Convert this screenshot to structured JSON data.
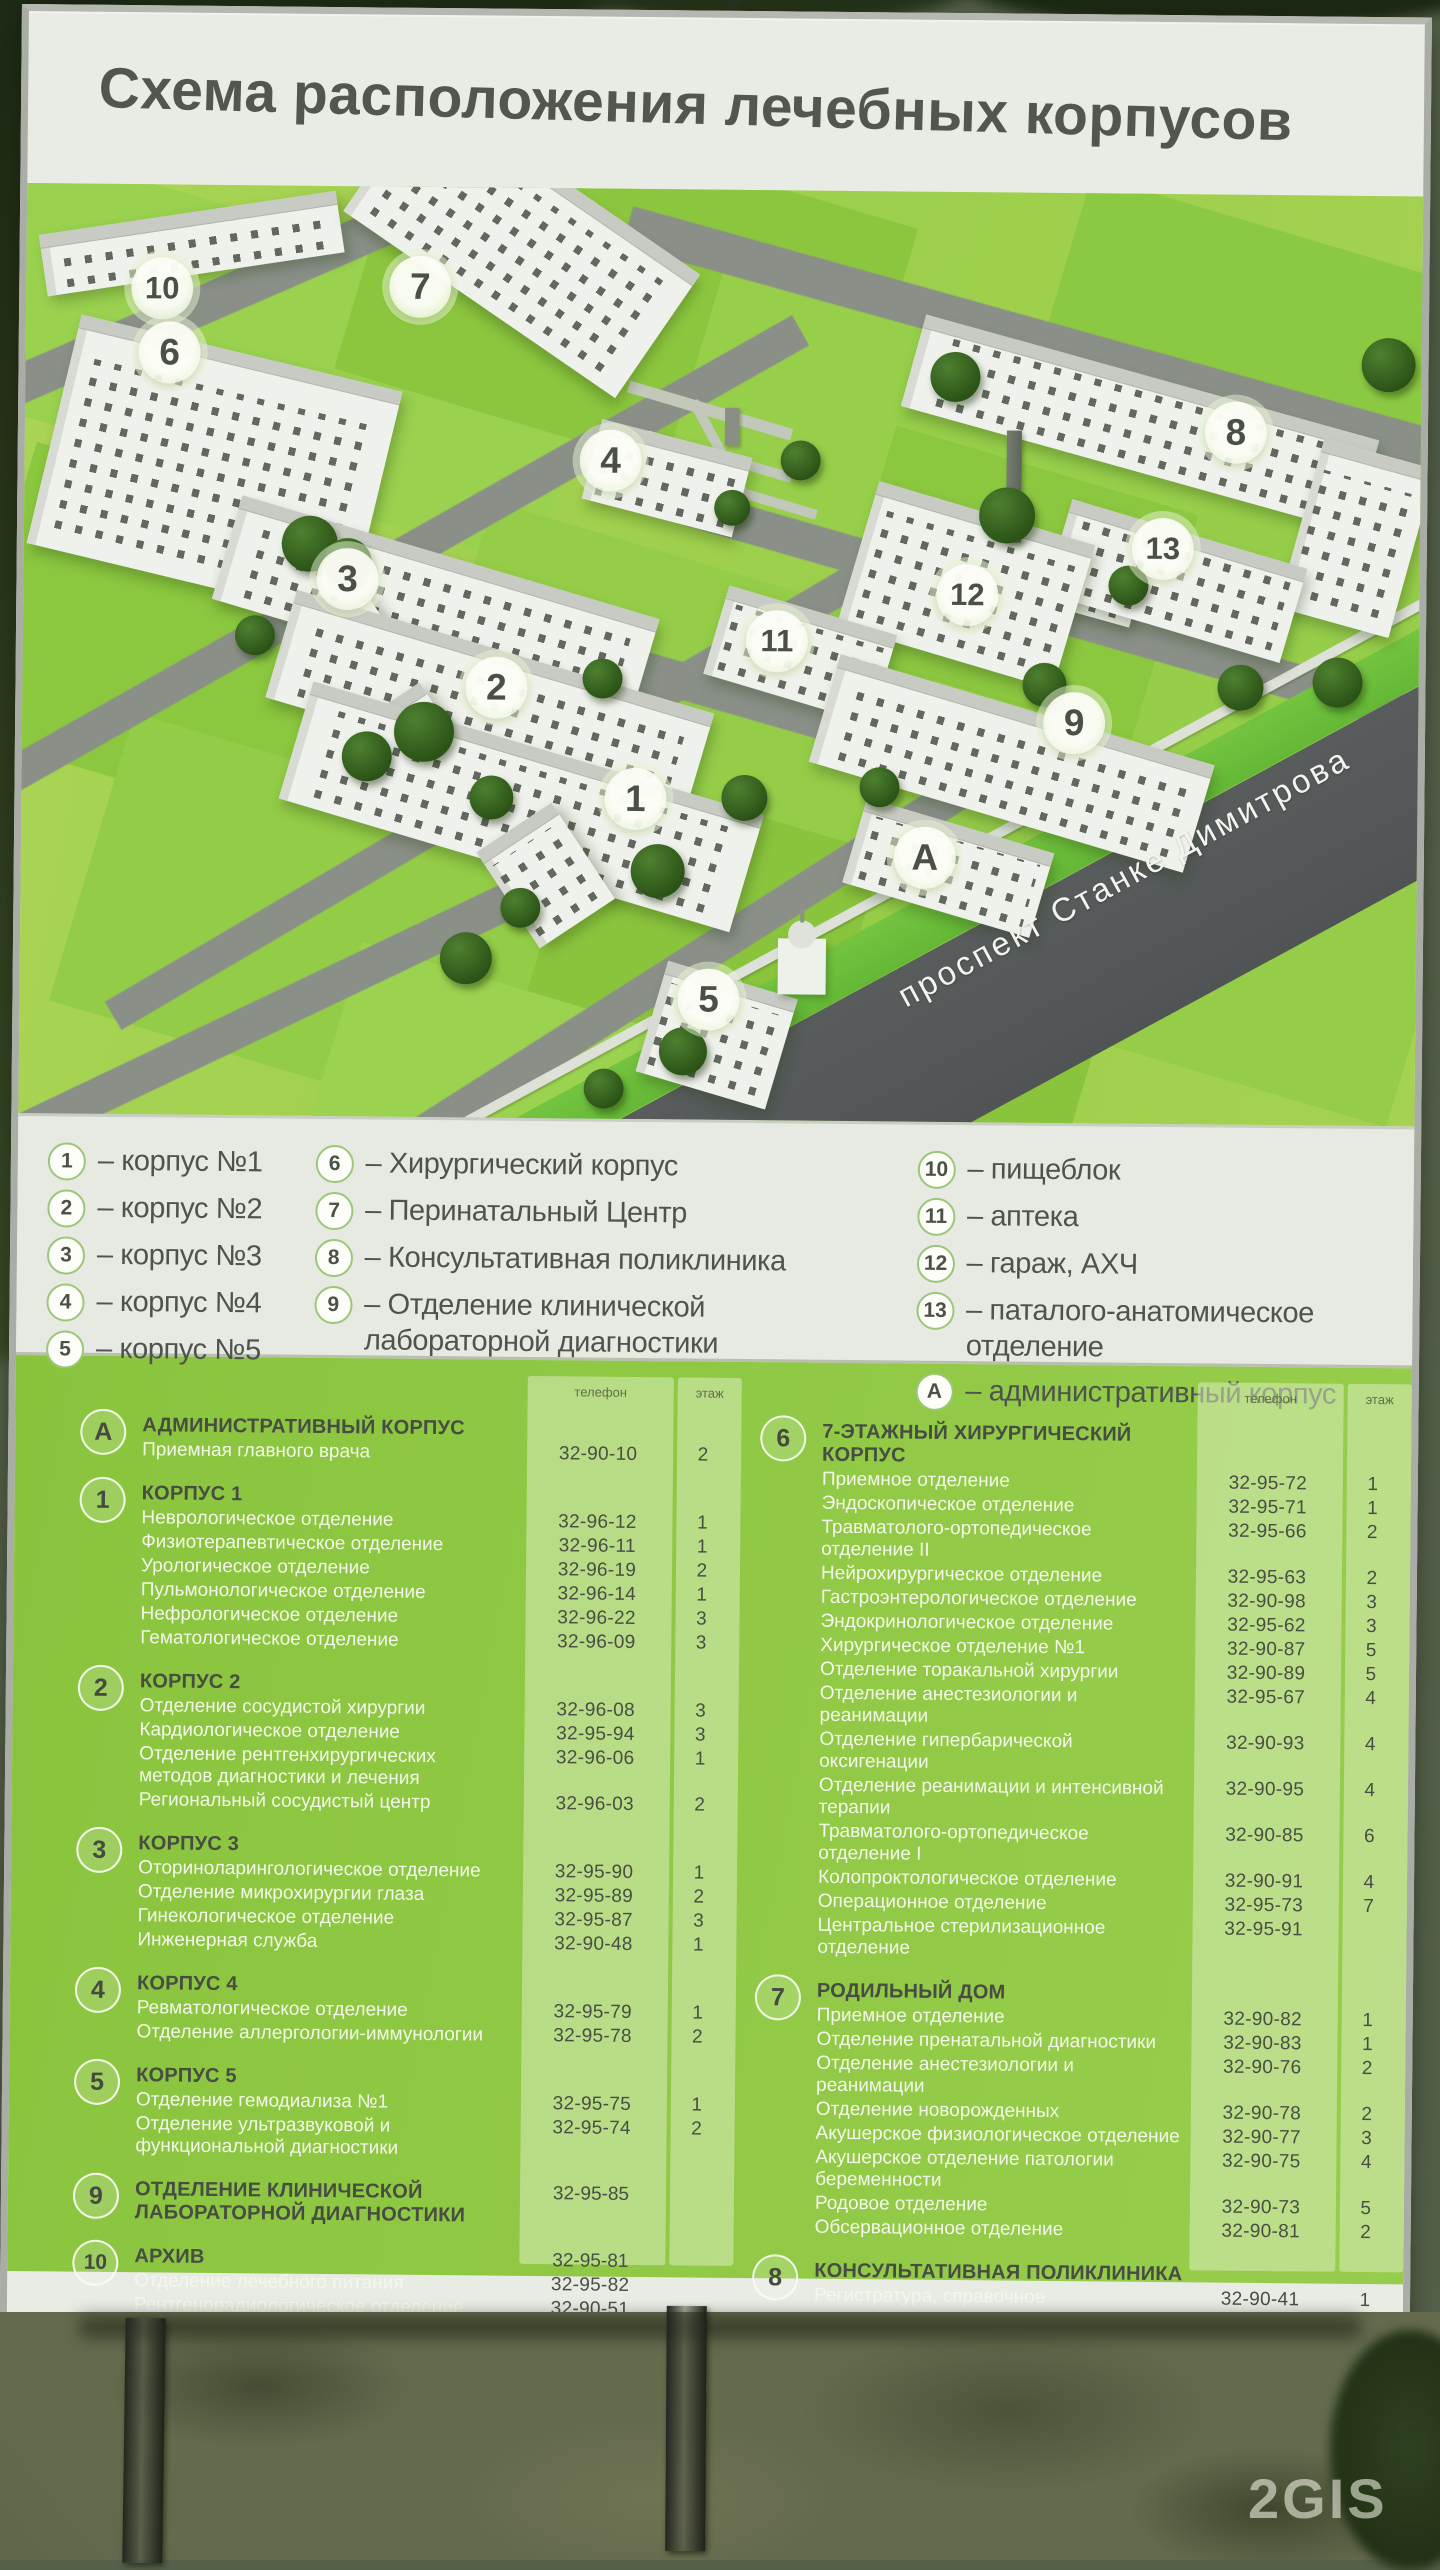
{
  "title": "Схема расположения лечебных корпусов",
  "watermark": "2GIS",
  "map": {
    "street": "проспект Станке Димитрова",
    "markers": [
      {
        "label": "10"
      },
      {
        "label": "7"
      },
      {
        "label": "6"
      },
      {
        "label": "4"
      },
      {
        "label": "8"
      },
      {
        "label": "13"
      },
      {
        "label": "3"
      },
      {
        "label": "12"
      },
      {
        "label": "11"
      },
      {
        "label": "2"
      },
      {
        "label": "9"
      },
      {
        "label": "1"
      },
      {
        "label": "А"
      },
      {
        "label": "5"
      }
    ]
  },
  "legend": {
    "columns": [
      [
        {
          "num": "1",
          "text": "– корпус №1"
        },
        {
          "num": "2",
          "text": "– корпус №2"
        },
        {
          "num": "3",
          "text": "– корпус №3"
        },
        {
          "num": "4",
          "text": "– корпус №4"
        },
        {
          "num": "5",
          "text": "– корпус №5"
        }
      ],
      [
        {
          "num": "6",
          "text": "– Хирургический корпус"
        },
        {
          "num": "7",
          "text": "– Перинатальный Центр"
        },
        {
          "num": "8",
          "text": "– Консультативная поликлиника"
        },
        {
          "num": "9",
          "text": "– Отделение клинической лабораторной диагностики"
        }
      ],
      [
        {
          "num": "10",
          "text": "– пищеблок"
        },
        {
          "num": "11",
          "text": "– аптека"
        },
        {
          "num": "12",
          "text": "– гараж, АХЧ"
        },
        {
          "num": "13",
          "text": "– паталого-анатомическое отделение"
        },
        {
          "num": "А",
          "text": "– административный корпус"
        }
      ]
    ]
  },
  "details": {
    "phone_col_label": "телефон",
    "floor_col_label": "этаж",
    "columns": [
      {
        "sections": [
          {
            "num": "А",
            "title": "АДМИНИСТРАТИВНЫЙ КОРПУС",
            "title_phone": "",
            "title_floor": "",
            "rows": [
              {
                "name": "Приемная главного врача",
                "phone": "32-90-10",
                "floor": "2"
              }
            ]
          },
          {
            "num": "1",
            "title": "КОРПУС 1",
            "title_phone": "",
            "title_floor": "",
            "rows": [
              {
                "name": "Неврологическое отделение",
                "phone": "32-96-12",
                "floor": "1"
              },
              {
                "name": "Физиотерапевтическое отделение",
                "phone": "32-96-11",
                "floor": "1"
              },
              {
                "name": "Урологическое отделение",
                "phone": "32-96-19",
                "floor": "2"
              },
              {
                "name": "Пульмонологическое отделение",
                "phone": "32-96-14",
                "floor": "1"
              },
              {
                "name": "Нефрологическое отделение",
                "phone": "32-96-22",
                "floor": "3"
              },
              {
                "name": "Гематологическое отделение",
                "phone": "32-96-09",
                "floor": "3"
              }
            ]
          },
          {
            "num": "2",
            "title": "КОРПУС 2",
            "title_phone": "",
            "title_floor": "",
            "rows": [
              {
                "name": "Отделение сосудистой хирургии",
                "phone": "32-96-08",
                "floor": "3"
              },
              {
                "name": "Кардиологическое отделение",
                "phone": "32-95-94",
                "floor": "3"
              },
              {
                "name": "Отделение рентгенхирургических методов диагностики и лечения",
                "phone": "32-96-06",
                "floor": "1"
              },
              {
                "name": "Региональный сосудистый центр",
                "phone": "32-96-03",
                "floor": "2"
              }
            ]
          },
          {
            "num": "3",
            "title": "КОРПУС 3",
            "title_phone": "",
            "title_floor": "",
            "rows": [
              {
                "name": "Оториноларингологическое отделение",
                "phone": "32-95-90",
                "floor": "1"
              },
              {
                "name": "Отделение микрохирургии глаза",
                "phone": "32-95-89",
                "floor": "2"
              },
              {
                "name": "Гинекологическое отделение",
                "phone": "32-95-87",
                "floor": "3"
              },
              {
                "name": "Инженерная служба",
                "phone": "32-90-48",
                "floor": "1"
              }
            ]
          },
          {
            "num": "4",
            "title": "КОРПУС 4",
            "title_phone": "",
            "title_floor": "",
            "rows": [
              {
                "name": "Ревматологическое отделение",
                "phone": "32-95-79",
                "floor": "1"
              },
              {
                "name": "Отделение аллергологии-иммунологии",
                "phone": "32-95-78",
                "floor": "2"
              }
            ]
          },
          {
            "num": "5",
            "title": "КОРПУС 5",
            "title_phone": "",
            "title_floor": "",
            "rows": [
              {
                "name": "Отделение гемодиализа №1",
                "phone": "32-95-75",
                "floor": "1"
              },
              {
                "name": "Отделение ультразвуковой и функциональной диагностики",
                "phone": "32-95-74",
                "floor": "2"
              }
            ]
          },
          {
            "num": "9",
            "title": "ОТДЕЛЕНИЕ КЛИНИЧЕСКОЙ ЛАБОРАТОРНОЙ ДИАГНОСТИКИ",
            "title_phone": "32-95-85",
            "title_floor": "",
            "rows": []
          },
          {
            "num": "10",
            "title": "АРХИВ",
            "title_phone": "32-95-81",
            "title_floor": "",
            "rows": [
              {
                "name": "Отделение лечебного питания",
                "phone": "32-95-82",
                "floor": ""
              },
              {
                "name": "Рентгенорадиологическое отделение",
                "phone": "32-90-51",
                "floor": ""
              }
            ]
          }
        ]
      },
      {
        "sections": [
          {
            "num": "6",
            "title": "7-ЭТАЖНЫЙ  ХИРУРГИЧЕСКИЙ КОРПУС",
            "title_phone": "",
            "title_floor": "",
            "rows": [
              {
                "name": "Приемное отделение",
                "phone": "32-95-72",
                "floor": "1"
              },
              {
                "name": "Эндоскопическое отделение",
                "phone": "32-95-71",
                "floor": "1"
              },
              {
                "name": "Травматолого-ортопедическое отделение II",
                "phone": "32-95-66",
                "floor": "2"
              },
              {
                "name": "Нейрохирургическое отделение",
                "phone": "32-95-63",
                "floor": "2"
              },
              {
                "name": "Гастроэнтерологическое отделение",
                "phone": "32-90-98",
                "floor": "3"
              },
              {
                "name": "Эндокринологическое отделение",
                "phone": "32-95-62",
                "floor": "3"
              },
              {
                "name": "Хирургическое отделение №1",
                "phone": "32-90-87",
                "floor": "5"
              },
              {
                "name": "Отделение торакальной хирургии",
                "phone": "32-90-89",
                "floor": "5"
              },
              {
                "name": "Отделение анестезиологии и реанимации",
                "phone": "32-95-67",
                "floor": "4"
              },
              {
                "name": "Отделение гипербарической оксигенации",
                "phone": "32-90-93",
                "floor": "4"
              },
              {
                "name": "Отделение реанимации и интенсивной терапии",
                "phone": "32-90-95",
                "floor": "4"
              },
              {
                "name": "Травматолого-ортопедическое отделение I",
                "phone": "32-90-85",
                "floor": "6"
              },
              {
                "name": "Колопроктологическое отделение",
                "phone": "32-90-91",
                "floor": "4"
              },
              {
                "name": "Операционное отделение",
                "phone": "32-95-73",
                "floor": "7"
              },
              {
                "name": "Центральное стерилизационное отделение",
                "phone": "32-95-91",
                "floor": ""
              }
            ]
          },
          {
            "num": "7",
            "title": "РОДИЛЬНЫЙ ДОМ",
            "title_phone": "",
            "title_floor": "",
            "rows": [
              {
                "name": "Приемное отделение",
                "phone": "32-90-82",
                "floor": "1"
              },
              {
                "name": "Отделение пренатальной диагностики",
                "phone": "32-90-83",
                "floor": "1"
              },
              {
                "name": "Отделение анестезиологии и реанимации",
                "phone": "32-90-76",
                "floor": "2"
              },
              {
                "name": "Отделение новорожденных",
                "phone": "32-90-78",
                "floor": "2"
              },
              {
                "name": "Акушерское физиологическое отделение",
                "phone": "32-90-77",
                "floor": "3"
              },
              {
                "name": "Акушерское отделение патологии беременности",
                "phone": "32-90-75",
                "floor": "4"
              },
              {
                "name": "Родовое отделение",
                "phone": "32-90-73",
                "floor": "5"
              },
              {
                "name": "Обсервационное  отделение",
                "phone": "32-90-81",
                "floor": "2"
              }
            ]
          },
          {
            "num": "8",
            "title": "КОНСУЛЬТАТИВНАЯ ПОЛИКЛИНИКА",
            "title_phone": "",
            "title_floor": "",
            "rows": [
              {
                "name": "Регистратура, справочное",
                "phone": "32-90-41",
                "floor": "1"
              },
              {
                "name": "Магнитно-резонансный томограф",
                "phone": "32-90-51",
                "floor": "1"
              },
              {
                "name": "Стоматологический кабинет",
                "phone": "32-90-50",
                "floor": "1"
              },
              {
                "name": "Центр профпатологии",
                "phone": "32-90-39",
                "floor": "1"
              },
              {
                "name": "Сурдологический кабинет",
                "phone": "32-90-39",
                "floor": "3"
              }
            ]
          }
        ]
      }
    ]
  }
}
